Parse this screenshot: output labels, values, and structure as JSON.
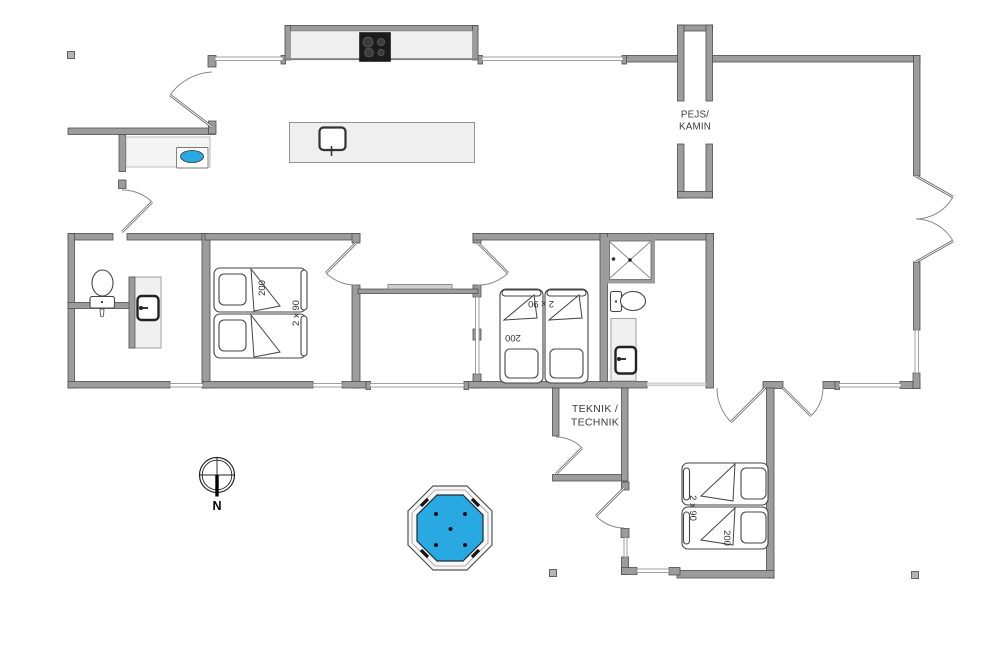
{
  "plan": {
    "fireplace": {
      "line1": "PEJS/",
      "line2": "KAMIN"
    },
    "utility_room": {
      "line1": "TEKNIK /",
      "line2": "TECHNIK"
    },
    "compass": {
      "north_label": "N"
    },
    "bedroom_west": {
      "bed_length_label": "200",
      "bed_width_label": "2 x 90"
    },
    "bedroom_middle": {
      "bed_length_label": "200",
      "bed_width_label": "2 x 90"
    },
    "bedroom_south": {
      "bed_length_label": "200",
      "bed_width_label": "2 x 90"
    },
    "colors": {
      "wall_gray": "#9c9c9c",
      "furniture_light": "#efefef",
      "hot_tub_blue": "#29a9e1",
      "cooktop_black": "#1b1b1b",
      "label_text": "#3b3b3b"
    }
  }
}
